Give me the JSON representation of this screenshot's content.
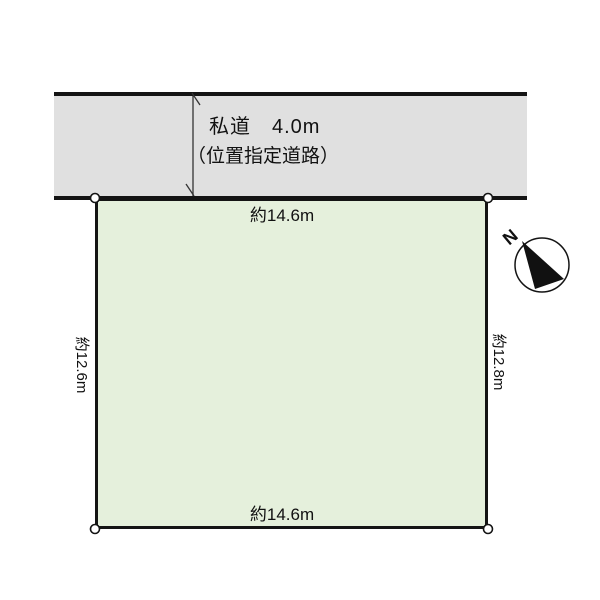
{
  "road": {
    "name_label": "私道　4.0m",
    "type_label": "（位置指定道路）",
    "width_value": "4.0m",
    "fill": "#e0e0e0"
  },
  "plot": {
    "top_label": "約14.6m",
    "bottom_label": "約14.6m",
    "left_label": "約12.6m",
    "right_label": "約12.8m",
    "fill": "#e5f0dc"
  },
  "compass": {
    "north_label": "N"
  },
  "colors": {
    "line": "#141414",
    "road_fill": "#e0e0e0",
    "plot_fill": "#e5f0dc",
    "background": "#ffffff"
  }
}
